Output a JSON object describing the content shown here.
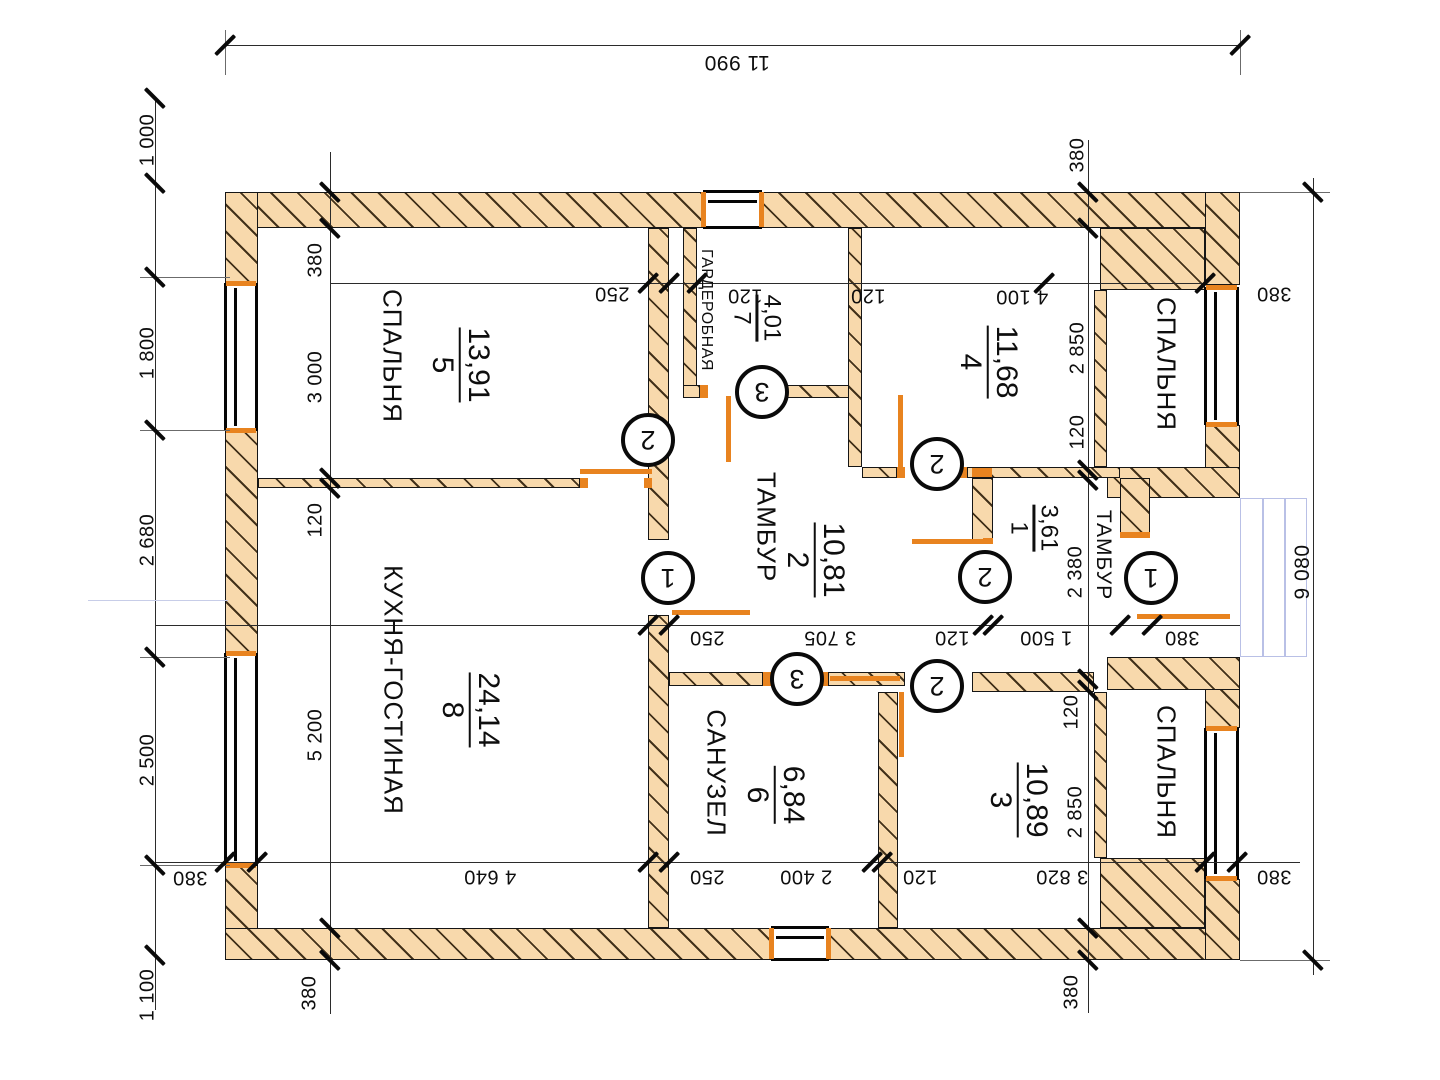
{
  "plan": {
    "colors": {
      "wall_fill": "#f8d9ac",
      "hatch": "#42311a",
      "door": "#e8831f",
      "porch": "#b9c0e6",
      "line": "#161616"
    },
    "rooms": [
      {
        "key": "bedroom-5",
        "name": "СПАЛЬНЯ",
        "number": "5",
        "area": "13,91"
      },
      {
        "key": "wardrobe-7",
        "name": "ГАРДЕРОБНАЯ",
        "number": "7",
        "area": "4,01"
      },
      {
        "key": "room-4",
        "name": "",
        "number": "4",
        "area": "11,68"
      },
      {
        "key": "bedroom-top-right",
        "name": "СПАЛЬНЯ",
        "number": "",
        "area": ""
      },
      {
        "key": "tambour-2",
        "name": "ТАМБУР",
        "number": "2",
        "area": "10,81"
      },
      {
        "key": "tambour-1",
        "name": "ТАМБУР",
        "number": "1",
        "area": "3,61"
      },
      {
        "key": "kitchen-living-8",
        "name": "КУХНЯ-ГОСТИНАЯ",
        "number": "8",
        "area": "24,14"
      },
      {
        "key": "bathroom-6",
        "name": "САНУЗЕЛ",
        "number": "6",
        "area": "6,84"
      },
      {
        "key": "room-3",
        "name": "",
        "number": "3",
        "area": "10,89"
      },
      {
        "key": "bedroom-bottom-right",
        "name": "СПАЛЬНЯ",
        "number": "",
        "area": ""
      }
    ],
    "dims": [
      {
        "t": "11 990"
      },
      {
        "t": "250"
      },
      {
        "t": "120"
      },
      {
        "t": "120"
      },
      {
        "t": "4 100"
      },
      {
        "t": "380"
      },
      {
        "t": "250"
      },
      {
        "t": "3 705"
      },
      {
        "t": "120"
      },
      {
        "t": "1 500"
      },
      {
        "t": "380"
      },
      {
        "t": "380"
      },
      {
        "t": "4 640"
      },
      {
        "t": "250"
      },
      {
        "t": "2 400"
      },
      {
        "t": "120"
      },
      {
        "t": "3 820"
      },
      {
        "t": "380"
      },
      {
        "t": "1 000"
      },
      {
        "t": "1 800"
      },
      {
        "t": "2 680"
      },
      {
        "t": "2 500"
      },
      {
        "t": "1 100"
      },
      {
        "t": "380"
      },
      {
        "t": "3 000"
      },
      {
        "t": "120"
      },
      {
        "t": "5 200"
      },
      {
        "t": "380"
      },
      {
        "t": "380"
      },
      {
        "t": "2 850"
      },
      {
        "t": "120"
      },
      {
        "t": "2 380"
      },
      {
        "t": "120"
      },
      {
        "t": "2 850"
      },
      {
        "t": "380"
      },
      {
        "t": "9 080"
      }
    ],
    "markers": [
      "2",
      "3",
      "2",
      "1",
      "2",
      "1",
      "3",
      "2"
    ]
  }
}
